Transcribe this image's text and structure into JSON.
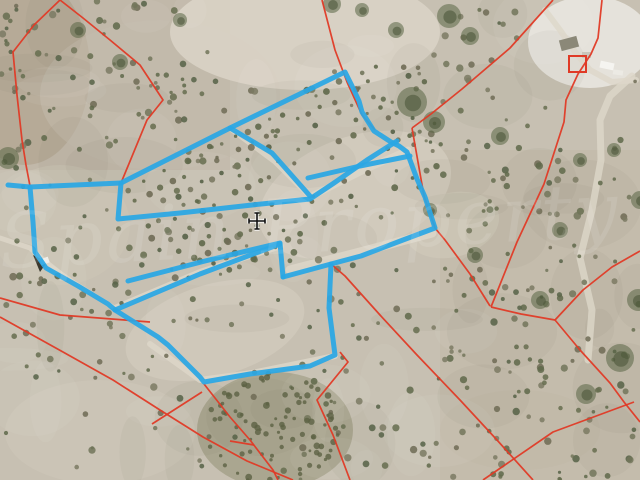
{
  "map": {
    "width": 640,
    "height": 480,
    "description": "aerial-cadastral-parcel-map",
    "colors": {
      "base": "#c7c0b2",
      "track": "#ddd7c9",
      "cadastral_red": "#e03a26",
      "selection_blue": "#2aa7e4",
      "cursor_black": "#111111",
      "watermark_white": "#ffffff"
    },
    "terrain": {
      "zones": [
        {
          "t": "rect",
          "x": 0,
          "y": 0,
          "w": 230,
          "h": 170,
          "fill": "#b6aa98",
          "op": 0.35
        },
        {
          "t": "ell",
          "cx": 25,
          "cy": 70,
          "rx": 65,
          "ry": 95,
          "fill": "#ab9c86",
          "op": 0.5
        },
        {
          "t": "ell",
          "cx": 160,
          "cy": 95,
          "rx": 120,
          "ry": 75,
          "fill": "#c3bcae",
          "op": 0.5
        },
        {
          "t": "ell",
          "cx": 305,
          "cy": 32,
          "rx": 135,
          "ry": 58,
          "fill": "#dad4c7",
          "op": 0.85
        },
        {
          "t": "ell",
          "cx": 590,
          "cy": 42,
          "rx": 62,
          "ry": 46,
          "fill": "#e7e4dd",
          "op": 0.95
        },
        {
          "t": "rect",
          "x": 440,
          "y": 150,
          "w": 200,
          "h": 330,
          "fill": "#bdb2a0",
          "op": 0.3
        },
        {
          "t": "ell",
          "cx": 355,
          "cy": 195,
          "rx": 100,
          "ry": 58,
          "rot": -20,
          "fill": "#d5cec0",
          "op": 0.7
        },
        {
          "t": "ell",
          "cx": 452,
          "cy": 225,
          "rx": 48,
          "ry": 32,
          "rot": -15,
          "fill": "#d2cabb",
          "op": 0.55
        },
        {
          "t": "ell",
          "cx": 215,
          "cy": 330,
          "rx": 92,
          "ry": 46,
          "rot": -16,
          "fill": "#d4cdbf",
          "op": 0.65
        },
        {
          "t": "ell",
          "cx": 100,
          "cy": 432,
          "rx": 95,
          "ry": 52,
          "rot": 0,
          "fill": "#cfc8b9",
          "op": 0.5
        },
        {
          "t": "ell",
          "cx": 60,
          "cy": 225,
          "rx": 70,
          "ry": 60,
          "rot": 0,
          "fill": "#cdc5b5",
          "op": 0.5
        },
        {
          "t": "ell",
          "cx": 275,
          "cy": 430,
          "rx": 78,
          "ry": 58,
          "rot": 0,
          "fill": "#8d8c6e",
          "op": 0.5
        },
        {
          "t": "ell",
          "cx": 520,
          "cy": 430,
          "rx": 80,
          "ry": 40,
          "rot": 0,
          "fill": "#c0b7a6",
          "op": 0.4
        }
      ],
      "tracks": [
        {
          "w": 5,
          "pts": [
            [
              0,
              238
            ],
            [
              30,
              248
            ],
            [
              46,
              262
            ],
            [
              60,
              273
            ]
          ]
        },
        {
          "w": 4,
          "pts": [
            [
              35,
              255
            ],
            [
              75,
              283
            ],
            [
              112,
              306
            ]
          ]
        },
        {
          "w": 6,
          "pts": [
            [
              115,
              308
            ],
            [
              200,
              272
            ],
            [
              281,
              246
            ]
          ]
        },
        {
          "w": 5,
          "pts": [
            [
              232,
              130
            ],
            [
              275,
              162
            ],
            [
              309,
              196
            ]
          ]
        },
        {
          "w": 7,
          "pts": [
            [
              310,
              197
            ],
            [
              360,
              172
            ],
            [
              408,
              150
            ]
          ]
        },
        {
          "w": 6,
          "pts": [
            [
              150,
              344
            ],
            [
              200,
              380
            ],
            [
              252,
              373
            ],
            [
              335,
              356
            ]
          ]
        },
        {
          "w": 9,
          "pts": [
            [
              290,
              270
            ],
            [
              360,
              252
            ],
            [
              432,
              233
            ]
          ]
        },
        {
          "w": 7,
          "pts": [
            [
              632,
              76
            ],
            [
              610,
              96
            ],
            [
              600,
              120
            ],
            [
              601,
              160
            ],
            [
              592,
              210
            ],
            [
              580,
              258
            ],
            [
              592,
              310
            ],
            [
              588,
              360
            ]
          ]
        },
        {
          "w": 6,
          "pts": [
            [
              545,
              10
            ],
            [
              560,
              30
            ],
            [
              575,
              52
            ],
            [
              590,
              70
            ],
            [
              612,
              82
            ],
            [
              636,
              80
            ]
          ]
        }
      ],
      "mottle_count": 70
    },
    "trees": {
      "seed": 20240711,
      "random_count": 900,
      "palette": [
        "#72755b",
        "#666d4f",
        "#7b7a63",
        "#5f684a",
        "#6f6b55",
        "#566247"
      ],
      "scrub_color": "#5c6243",
      "clusters": [
        [
          412,
          102,
          15
        ],
        [
          434,
          122,
          11
        ],
        [
          449,
          16,
          12
        ],
        [
          470,
          36,
          9
        ],
        [
          332,
          4,
          9
        ],
        [
          362,
          10,
          7
        ],
        [
          396,
          30,
          8
        ],
        [
          500,
          136,
          9
        ],
        [
          8,
          158,
          11
        ],
        [
          620,
          358,
          14
        ],
        [
          586,
          394,
          10
        ],
        [
          638,
          300,
          11
        ],
        [
          560,
          230,
          8
        ],
        [
          614,
          150,
          7
        ],
        [
          120,
          62,
          8
        ],
        [
          78,
          30,
          8
        ],
        [
          180,
          20,
          7
        ],
        [
          540,
          300,
          9
        ],
        [
          475,
          255,
          8
        ],
        [
          430,
          210,
          7
        ],
        [
          640,
          200,
          9
        ],
        [
          580,
          160,
          7
        ]
      ],
      "cluster_color": "#5a6646"
    },
    "cadastral": {
      "color": "#e03a26",
      "width": 1.7,
      "lines": [
        [
          [
            60,
            0
          ],
          [
            34,
            25
          ],
          [
            13,
            52
          ],
          [
            17,
            95
          ],
          [
            22,
            140
          ],
          [
            26,
            165
          ],
          [
            30,
            186
          ]
        ],
        [
          [
            60,
            0
          ],
          [
            83,
            18
          ],
          [
            110,
            40
          ],
          [
            140,
            65
          ],
          [
            163,
            100
          ],
          [
            147,
            120
          ],
          [
            121,
            183
          ]
        ],
        [
          [
            322,
            0
          ],
          [
            335,
            50
          ],
          [
            347,
            82
          ],
          [
            362,
            115
          ],
          [
            375,
            130
          ]
        ],
        [
          [
            553,
            0
          ],
          [
            510,
            48
          ],
          [
            462,
            89
          ],
          [
            431,
            114
          ],
          [
            412,
            128
          ]
        ],
        [
          [
            602,
            0
          ],
          [
            598,
            38
          ],
          [
            591,
            54
          ],
          [
            578,
            74
          ],
          [
            566,
            100
          ],
          [
            564,
            122
          ],
          [
            544,
            184
          ],
          [
            517,
            242
          ],
          [
            491,
            307
          ]
        ],
        [
          [
            412,
            128
          ],
          [
            424,
            196
          ],
          [
            435,
            228
          ],
          [
            445,
            240
          ],
          [
            470,
            274
          ],
          [
            490,
            306
          ]
        ],
        [
          [
            491,
            307
          ],
          [
            521,
            314
          ],
          [
            555,
            320
          ]
        ],
        [
          [
            555,
            320
          ],
          [
            583,
            290
          ],
          [
            612,
            267
          ],
          [
            640,
            251
          ]
        ],
        [
          [
            555,
            320
          ],
          [
            580,
            350
          ],
          [
            610,
            383
          ],
          [
            624,
            402
          ],
          [
            640,
            422
          ]
        ],
        [
          [
            331,
            264
          ],
          [
            345,
            276
          ],
          [
            380,
            315
          ],
          [
            417,
            355
          ],
          [
            460,
            400
          ],
          [
            497,
            440
          ],
          [
            533,
            480
          ]
        ],
        [
          [
            0,
            317
          ],
          [
            63,
            352
          ],
          [
            113,
            380
          ],
          [
            160,
            410
          ],
          [
            203,
            437
          ],
          [
            247,
            461
          ],
          [
            293,
            480
          ]
        ],
        [
          [
            204,
            384
          ],
          [
            230,
            417
          ],
          [
            250,
            440
          ],
          [
            273,
            470
          ],
          [
            278,
            480
          ]
        ],
        [
          [
            202,
            392
          ],
          [
            152,
            424
          ]
        ],
        [
          [
            340,
            352
          ],
          [
            348,
            362
          ],
          [
            317,
            400
          ],
          [
            333,
            435
          ],
          [
            350,
            480
          ]
        ],
        [
          [
            0,
            298
          ],
          [
            60,
            315
          ],
          [
            150,
            322
          ]
        ],
        [
          [
            483,
            480
          ],
          [
            553,
            432
          ],
          [
            634,
            402
          ]
        ],
        [
          [
            230,
            441
          ],
          [
            254,
            445
          ]
        ]
      ],
      "marker_rect": {
        "x": 569,
        "y": 56,
        "w": 17,
        "h": 16,
        "stroke_width": 2
      }
    },
    "selection": {
      "color": "#2aa7e4",
      "width": 5,
      "opacity": 0.93,
      "lines": [
        [
          [
            8,
            185
          ],
          [
            30,
            187
          ],
          [
            121,
            183
          ]
        ],
        [
          [
            30,
            187
          ],
          [
            33,
            222
          ],
          [
            35,
            252
          ],
          [
            46,
            268
          ],
          [
            78,
            286
          ],
          [
            108,
            304
          ],
          [
            115,
            310
          ]
        ],
        [
          [
            121,
            183
          ],
          [
            230,
            128
          ],
          [
            345,
            72
          ],
          [
            352,
            86
          ],
          [
            359,
            101
          ],
          [
            362,
            112
          ],
          [
            374,
            131
          ],
          [
            391,
            142
          ],
          [
            399,
            146
          ],
          [
            407,
            152
          ],
          [
            417,
            179
          ],
          [
            425,
            197
          ],
          [
            435,
            228
          ],
          [
            403,
            240
          ],
          [
            361,
            256
          ],
          [
            331,
            264
          ],
          [
            283,
            277
          ]
        ],
        [
          [
            121,
            183
          ],
          [
            118,
            219
          ],
          [
            180,
            213
          ],
          [
            252,
            205
          ],
          [
            310,
            199
          ],
          [
            334,
            183
          ],
          [
            367,
            160
          ],
          [
            397,
            141
          ]
        ],
        [
          [
            230,
            128
          ],
          [
            272,
            153
          ],
          [
            310,
            196
          ]
        ],
        [
          [
            308,
            178
          ],
          [
            360,
            166
          ],
          [
            410,
            156
          ]
        ],
        [
          [
            128,
            281
          ],
          [
            205,
            261
          ],
          [
            280,
            243
          ],
          [
            283,
            277
          ]
        ],
        [
          [
            280,
            244
          ],
          [
            200,
            274
          ],
          [
            115,
            310
          ]
        ],
        [
          [
            115,
            310
          ],
          [
            158,
            337
          ],
          [
            168,
            345
          ],
          [
            200,
            377
          ],
          [
            204,
            382
          ],
          [
            250,
            374
          ],
          [
            310,
            366
          ],
          [
            335,
            355
          ],
          [
            329,
            308
          ],
          [
            331,
            264
          ]
        ]
      ]
    },
    "buildings": [
      {
        "t": "rect",
        "x": 560,
        "y": 38,
        "w": 18,
        "h": 11,
        "fill": "#8b8878",
        "rot": -15
      },
      {
        "t": "rect",
        "x": 600,
        "y": 62,
        "w": 14,
        "h": 7,
        "fill": "#f5f4f0",
        "rot": 12
      },
      {
        "t": "rect",
        "x": 613,
        "y": 70,
        "w": 10,
        "h": 5,
        "fill": "#eceae4",
        "rot": 8
      },
      {
        "t": "rect",
        "x": 582,
        "y": 52,
        "w": 9,
        "h": 6,
        "fill": "#c9c5ba",
        "rot": 0
      },
      {
        "t": "poly",
        "pts": [
          [
            33,
            255
          ],
          [
            47,
            262
          ],
          [
            40,
            272
          ]
        ],
        "fill": "#3a382e"
      },
      {
        "t": "rect",
        "x": 40,
        "y": 258,
        "w": 9,
        "h": 6,
        "fill": "#efeee9",
        "rot": -20
      }
    ],
    "cursor": {
      "x": 257,
      "y": 221
    },
    "watermark": {
      "text": "Spain Property",
      "x": 310,
      "y": 252,
      "size": 76,
      "rotate": -3,
      "opacity": 0.1,
      "letter_spacing": 3,
      "color": "#ffffff"
    }
  }
}
